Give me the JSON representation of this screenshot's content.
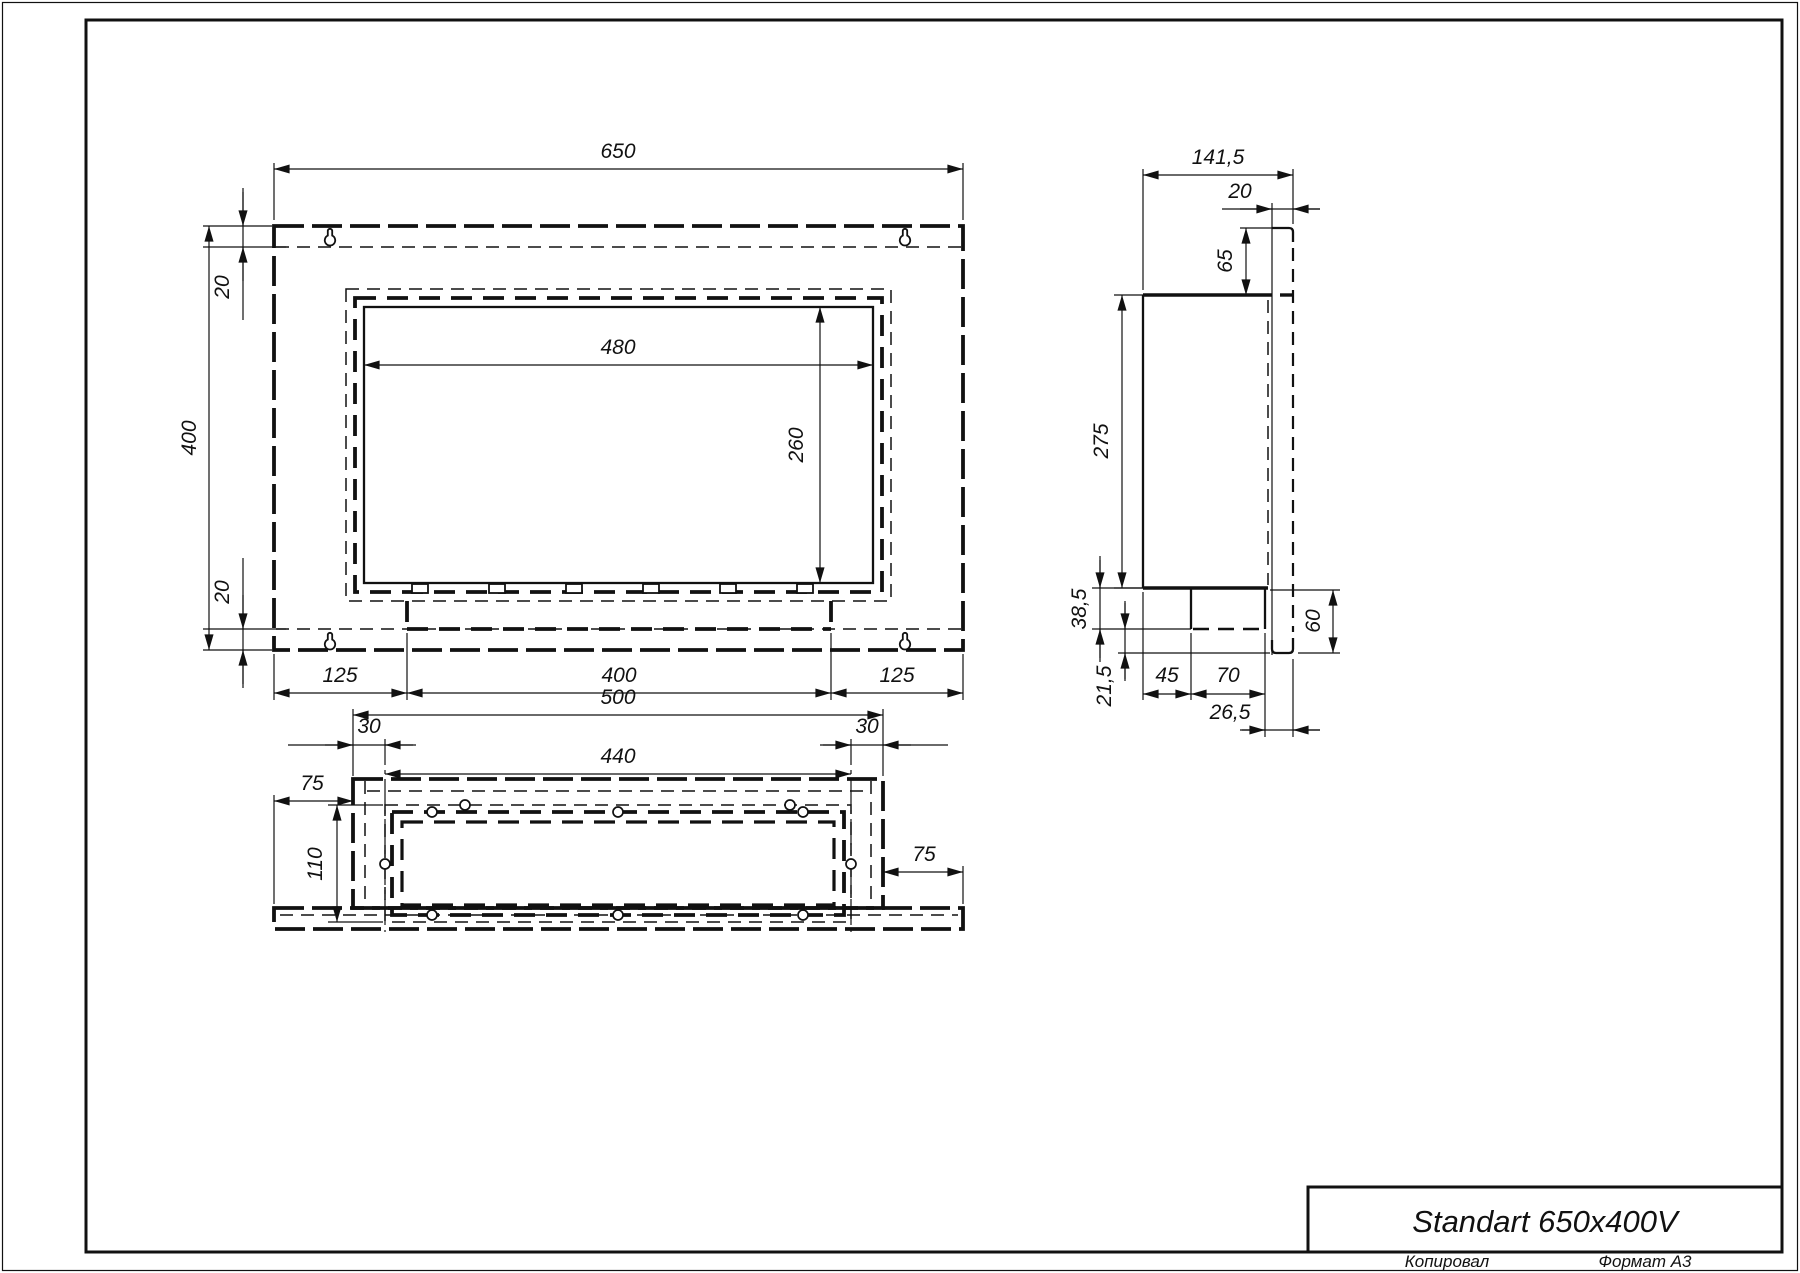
{
  "title_block": {
    "product_title": "Standart 650x400V",
    "copied_by_label": "Копировал",
    "format_label": "Формат А3"
  },
  "front": {
    "width": "650",
    "height": "400",
    "offset_top": "20",
    "offset_bottom": "20",
    "opening_width": "480",
    "opening_height": "260",
    "foot_left": "125",
    "foot_center": "400",
    "foot_right": "125"
  },
  "side": {
    "depth_total": "141,5",
    "flange_thickness": "20",
    "flange_overhang": "65",
    "body_height": "275",
    "tray_height": "38,5",
    "bottom_gap": "21,5",
    "tray_front_offset": "45",
    "tray_depth": "70",
    "tray_back_offset": "26,5",
    "lower_height": "60"
  },
  "bottom": {
    "body_width": "500",
    "inset_left": "30",
    "inset_right": "30",
    "burner_width": "440",
    "flange_overhang_left": "75",
    "flange_overhang_right": "75",
    "burner_depth": "110"
  }
}
